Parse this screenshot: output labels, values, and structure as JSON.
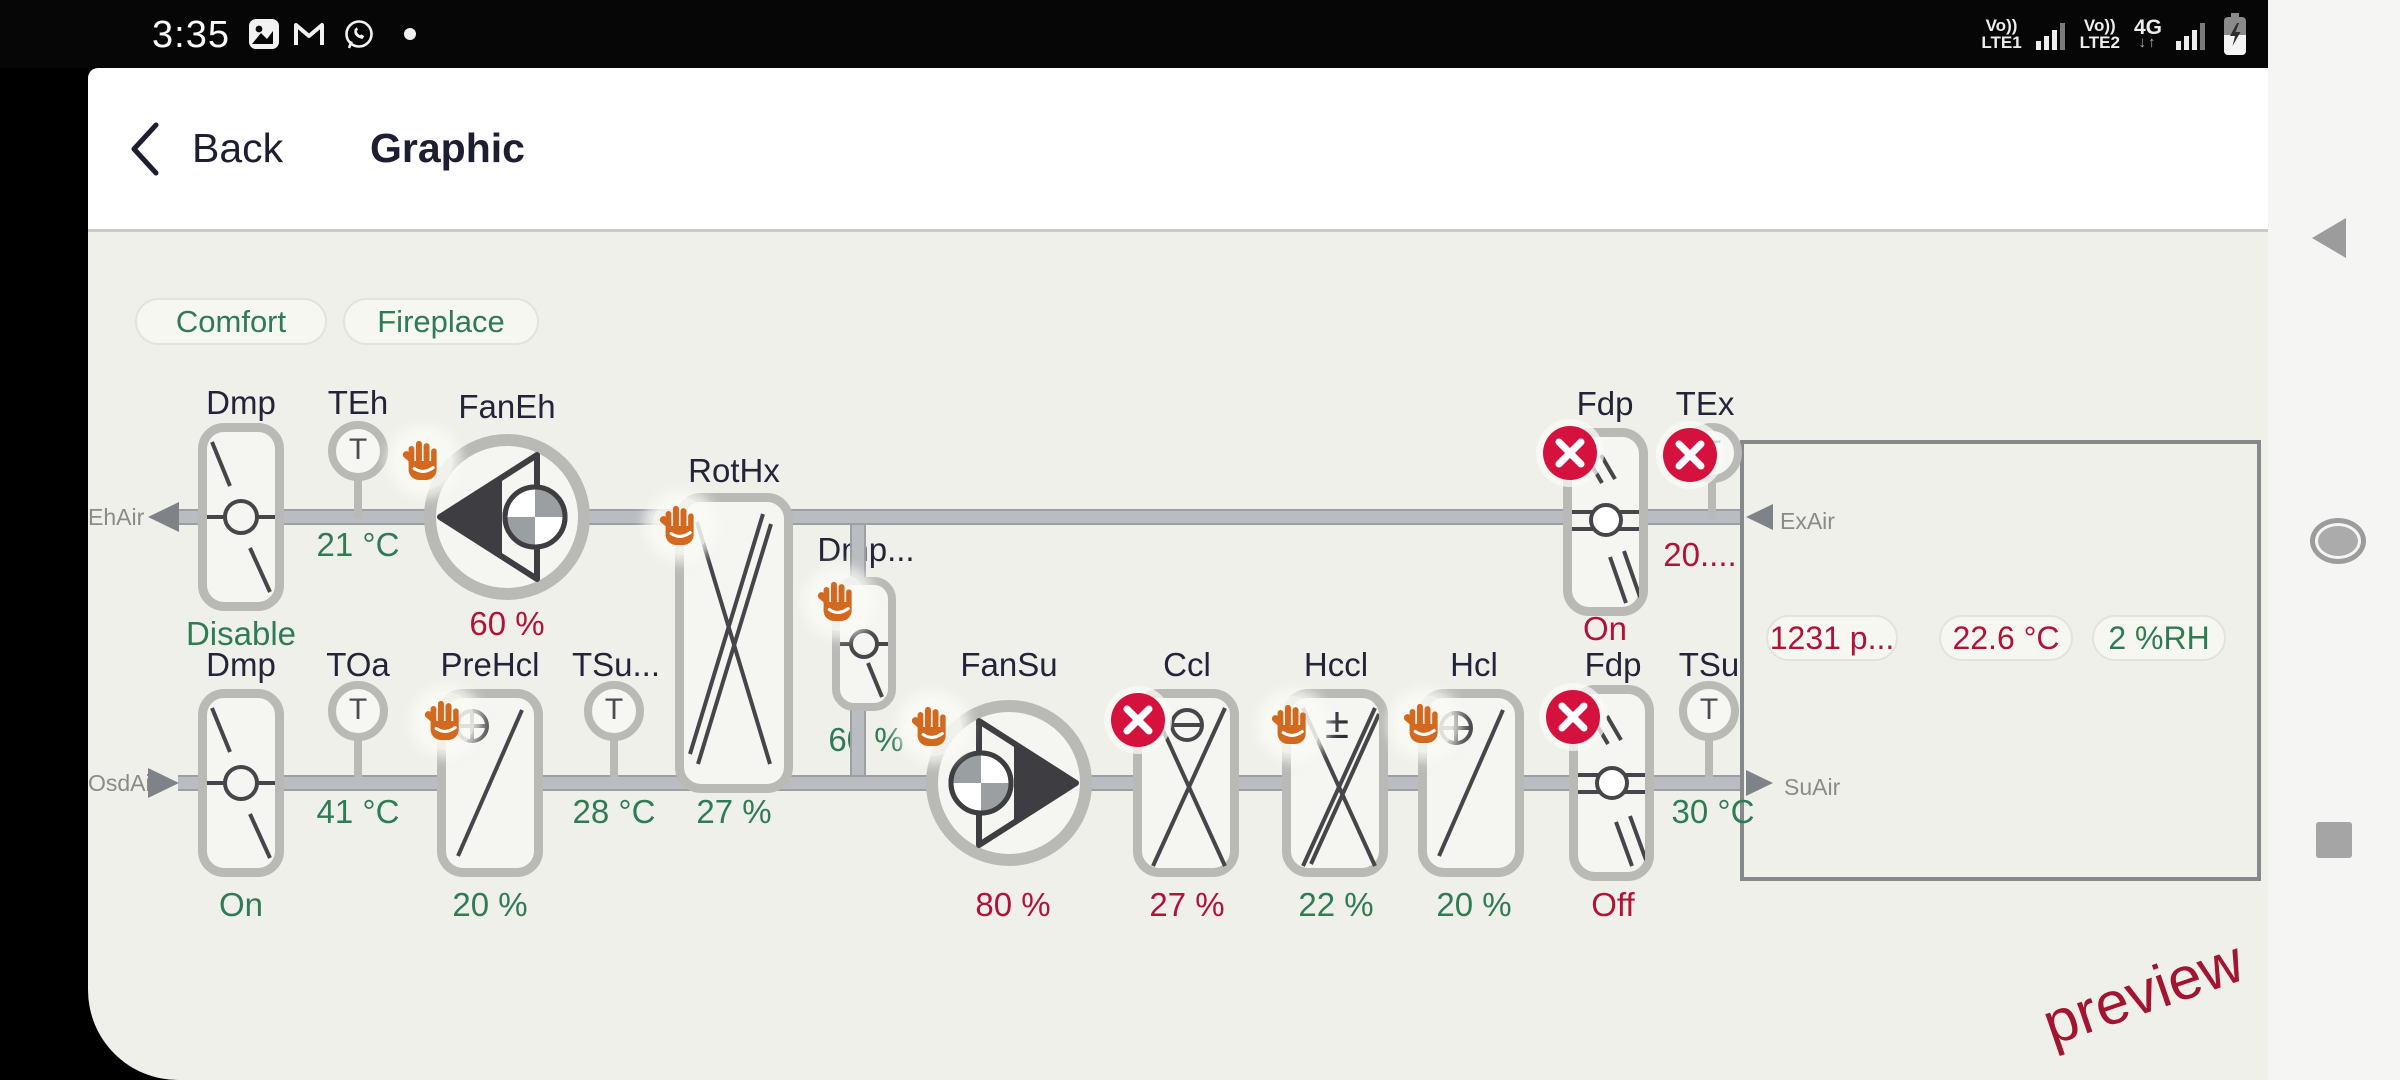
{
  "status_bar": {
    "time": "3:35",
    "left_icons": [
      "gallery-icon",
      "gmail-icon",
      "whatsapp-icon",
      "notification-dot"
    ],
    "sim1_voice": "Vo))",
    "sim1_net": "LTE1",
    "sim2_voice": "Vo))",
    "sim2_net": "LTE2",
    "data_mode": "4G",
    "data_arrows": "↓↑",
    "battery": "charging"
  },
  "nav_icons": [
    "back-triangle",
    "home-circle",
    "recents-square"
  ],
  "header": {
    "back_label": "Back",
    "title": "Graphic"
  },
  "scenes": {
    "comfort": "Comfort",
    "fireplace": "Fireplace"
  },
  "air": {
    "ehair": "EhAir",
    "osdair": "OsdAir",
    "exair": "ExAir",
    "suair": "SuAir"
  },
  "sensor_glyph": "T",
  "components": {
    "dmp_eh": {
      "label": "Dmp",
      "value": "Disable"
    },
    "teh": {
      "label": "TEh",
      "value": "21 °C"
    },
    "fan_eh": {
      "label": "FanEh",
      "value": "60 %"
    },
    "rothx": {
      "label": "RotHx",
      "value": "27 %"
    },
    "dmp_byp": {
      "label": "Dmp...",
      "value": "60 %"
    },
    "fdp_eh": {
      "label": "Fdp",
      "value": "On"
    },
    "tex": {
      "label": "TEx",
      "value": "20...."
    },
    "dmp_oa": {
      "label": "Dmp",
      "value": "On"
    },
    "toa": {
      "label": "TOa",
      "value": "41 °C"
    },
    "prehcl": {
      "label": "PreHcl",
      "value": "20 %"
    },
    "tsu_ahu": {
      "label": "TSu...",
      "value": "28 °C"
    },
    "fan_su": {
      "label": "FanSu",
      "value": "80 %"
    },
    "ccl": {
      "label": "Ccl",
      "value": "27 %"
    },
    "hccl": {
      "label": "Hccl",
      "value": "22 %",
      "mark": "±"
    },
    "hcl": {
      "label": "Hcl",
      "value": "20 %"
    },
    "fdp_su": {
      "label": "Fdp",
      "value": "Off"
    },
    "tsu": {
      "label": "TSu",
      "value": "30 °C"
    }
  },
  "room": {
    "pressure": "1231 p...",
    "temperature": "22.6 °C",
    "humidity": "2 %RH"
  },
  "watermark": "preview",
  "colors": {
    "value_green": "#2f7b53",
    "value_red": "#b11338",
    "badge_red": "#d5123e",
    "hand_orange": "#d2691e",
    "content_bg": "#f0f0ea",
    "text_dark": "#23233a"
  }
}
